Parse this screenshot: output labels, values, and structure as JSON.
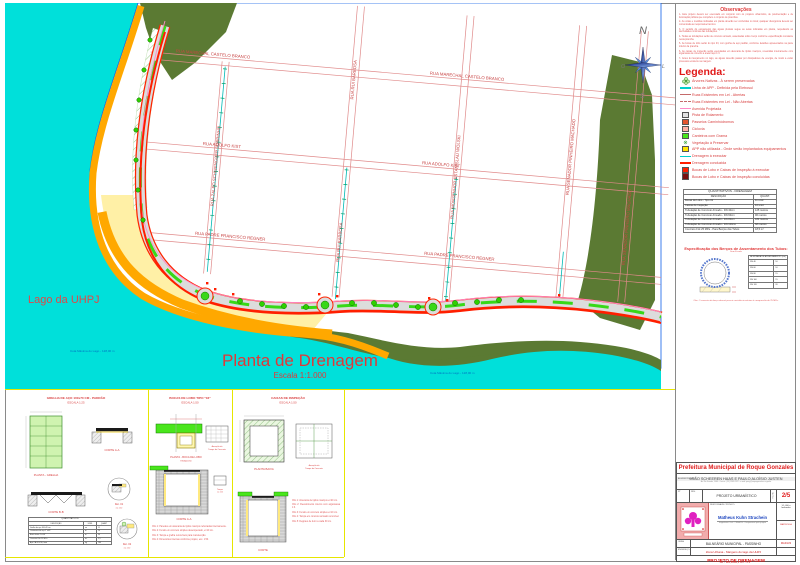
{
  "colors": {
    "water": "#00e0da",
    "olive": "#5b7a33",
    "orange": "#ffa800",
    "sand": "#fff0a6",
    "road": "#dcdcdc",
    "grass": "#38d818",
    "drain_red": "#ff1e00",
    "street_line": "#e08a8a",
    "label_red": "#c84444",
    "title_red": "#e03838",
    "pink": "#ff8ac8",
    "teal": "#00b8b4"
  },
  "map": {
    "title": "Planta de Drenagem",
    "subtitle": "Escala 1:1.000",
    "lake_label": "Lago da UHPJ",
    "street_labels": [
      "RUA MARECHAL CASTELO BRANCO",
      "RUA MARECHAL CASTELO BRANCO",
      "RUA ADOLFO KIST",
      "RUA ADOLFO KIST",
      "RUA PADRE FRANCISCO REGNER",
      "RUA PADRE FRANCISCO REGNER",
      "RUA ZALEO SCHWENGBER SOBRINHO",
      "RUA RUI BARBOSA",
      "RUA RUI BARBOSA",
      "RUA MONSENHOR ESTANISLAU WOLSKI",
      "RUA SENADOR PINHEIRO MACHADO",
      "RUA SENADOR PINHEIRO MACHADO"
    ],
    "water_labels": [
      "Cota Máxima do Lago - 128,00 m",
      "Cota Máxima do Lago - 128,00 m"
    ]
  },
  "compass": {
    "n": "N",
    "s": "S",
    "w": "O",
    "e": "L"
  },
  "observations": {
    "title": "Observações",
    "items": [
      "1- Este projeto deverá ser executado em conjunto com os projetos urbanístico, de pavimentação e de iluminação pública que compõem o conjunto de pranchas.",
      "2- As cotas e medidas indicadas em planta deverão ser conferidas no local; qualquer divergência deverá ser comunicada ao responsável técnico.",
      "3- O sentido do escoamento das águas pluviais segue as setas indicadas em planta, respeitando as declividades mínimas das tubulações.",
      "4- Todas as tubulações serão de concreto armado, assentadas sobre berço conforme especificação constante nesta prancha.",
      "5- As bocas de lobo serão do tipo 03, com grelha de aço padrão, conforme detalhes apresentados na parte inferior da prancha.",
      "6- As caixas de inspeção serão executadas em alvenaria de tijolos maciços, revestidas internamente com argamassa de cimento e areia traço 1:3.",
      "7- Antes do lançamento no lago, as águas deverão passar por dissipadores de energia, de modo a evitar processos erosivos na margem."
    ]
  },
  "legend": {
    "title": "Legenda:",
    "items": [
      {
        "label": "Árvores Nativas - À serem preservadas"
      },
      {
        "label": "Linha de APP - Definida pela Eletrosul"
      },
      {
        "label": "Ruas Existentes em Lei - Abertas"
      },
      {
        "label": "Ruas Existentes em Lei - Não Abertas"
      },
      {
        "label": "Avenida Projetada"
      },
      {
        "label": "Pista de Rolamento"
      },
      {
        "label": "Passeios Caminhódromos"
      },
      {
        "label": "Ciclovia"
      },
      {
        "label": "Canteiros com Grama"
      },
      {
        "label": "Vegetação à Preservar"
      },
      {
        "label": "APP não utilizada - Onde serão implantados equipamentos"
      },
      {
        "label": "Drenagem à executar"
      },
      {
        "label": "Drenagem conduzida"
      },
      {
        "label": "Bocas de Lobo e Caixas de Inspeção à executar"
      },
      {
        "label": "Bocas de Lobo e Caixas de Inspeção concluídas"
      }
    ]
  },
  "quantitativos": {
    "title": "QUANTITATIVOS - DRENAGEM",
    "columns": [
      "DESCRIÇÃO",
      "QUANT."
    ],
    "rows": [
      [
        "Bocas de Lobo - Tipo 03",
        "11 unid"
      ],
      [
        "Caixas de Inspeção",
        "10 unid"
      ],
      [
        "Tubulação de Concreto Armado - DN 40cm",
        "125 metros"
      ],
      [
        "Tubulação de Concreto Armado - DN 60cm",
        "96 metros"
      ],
      [
        "Tubulação de Concreto Armado - DN 80cm",
        "184 metros"
      ],
      [
        "Tubulação de Concreto Armado - DN 100cm",
        "68 metros"
      ],
      [
        "Concreto Fck 25 MPa - Para Berços dos Tubos",
        "18,5 m³"
      ]
    ]
  },
  "bercos": {
    "title": "Especificação dos Berços de Assentamento dos Tubos:",
    "subtitle": "Sem Escala",
    "table_title": "ALMOFADA DE ASSENTAMENTO (cm)",
    "rows": [
      [
        "DN 40",
        "10"
      ],
      [
        "DN 60",
        "10"
      ],
      [
        "DN 80",
        "15"
      ],
      [
        "DN 100",
        "15"
      ],
      [
        "DN 120",
        "20"
      ]
    ],
    "note": "Obs: O concreto do berço deverá possuir resistência mínima à compressão de 25 MPa."
  },
  "details": {
    "grelha": {
      "title": "GRELHA DE AÇO 100x70 CM - PADRÃO",
      "scale": "ESCALA 1:25",
      "planta": "PLANTA - GRELHA",
      "corte_a": "CORTE A-A",
      "corte_b": "CORTE B-B",
      "det1": "Det. 01",
      "det1_esc": "esc 1:10",
      "det2": "Det. 02",
      "det2_esc": "esc 1:10",
      "table_title": "QUANTITATIVOS",
      "columns": [
        "DESCRIÇÃO",
        "UNID",
        "QUANT"
      ],
      "rows": [
        [
          "Grelha de aço 100x70 cm",
          "un",
          "11"
        ],
        [
          "Cantoneira de aço 2\"x3/8\"",
          "m",
          "24"
        ],
        [
          "Barra chata 1\"x3/8\"",
          "m",
          "96"
        ],
        [
          "Concreto Fck 25 MPa",
          "m³",
          "2,5"
        ],
        [
          "Aço CA-50 Ø 8,0 mm",
          "kg",
          "180"
        ]
      ]
    },
    "boca": {
      "title": "BOCAS DE LOBO TIPO \"03\"",
      "scale": "ESCALA 1:50",
      "planta": "PLANTA - BOCA DE LOBO",
      "planta_esc": "ESCALA 1/50",
      "armacao1": "Armação da",
      "armacao2": "Tampa de Concreto",
      "corte": "CORTE A-A",
      "tampa": "Tampa",
      "tampa_esc": "esc 1:20",
      "notes": [
        "Obs 1: Paredes em alvenaria de tijolos maciços rebocadas internamente.",
        "Obs 2: Fundo em concreto simples desempenado, e=10 cm.",
        "Obs 3: Tampa e grelha removíveis para manutenção.",
        "Obs 4: Dimensões internas conforme projeto, esc. 1:50."
      ]
    },
    "caixa": {
      "title": "CAIXAS DE INSPEÇÃO",
      "scale": "ESCALA 1:50",
      "planta": "PLANTA BAIXA",
      "armacao1": "Armação da",
      "armacao2": "Tampa de Concreto",
      "corte": "CORTE",
      "notes": [
        "Obs 1: Alvenaria de tijolos maciços e=20 cm.",
        "Obs 2: Revestimento interno com argamassa 1:3.",
        "Obs 3: Fundo em concreto simples e=10 cm.",
        "Obs 4: Tampa em concreto armado removível.",
        "Obs 5: Degraus de ferro a cada 30 cm."
      ]
    }
  },
  "titleblock": {
    "municipality": "Prefeitura Municipal de Roque Gonzales",
    "admin_label": "ADMINISTRAÇÃO:",
    "admin": "JOÃO SCHEEREN HAAS E PAULO ALOÍSIO JUSTEN",
    "contact": "Av. Rio Grande, 1060 - Centro - (55) 3583-1122 - e-mail: pmrg@roquegonzales.rs.gov.br",
    "box1": "Nº",
    "box2": "REV.",
    "project_type": "PROJETO URBANÍSTICO",
    "folha_label": "FOLHA",
    "sheet": "2/5",
    "resp_label": "RESPONSÁVEL TÉCNICO:",
    "resp_name": "Matheus Kuhn Strachein",
    "resp_info": "Engenheiro Civil - CREA/RS - Responsável pelo projeto",
    "scale_box": "1:1.000 e Indicadas",
    "matricula": "MATRÍCULA",
    "obra_label": "OBRA:",
    "obra": "BALNEÁRIO MUNICIPAL - PASSINHO",
    "date": "MAIO/23",
    "endereco_label": "ENDEREÇO:",
    "endereco": "Zona Urbana - Margens do lago da UHPJ",
    "project_title": "PROJETO DE DRENAGEM",
    "paper": "A0 - 118,9x84,1 cm - 1:1"
  }
}
